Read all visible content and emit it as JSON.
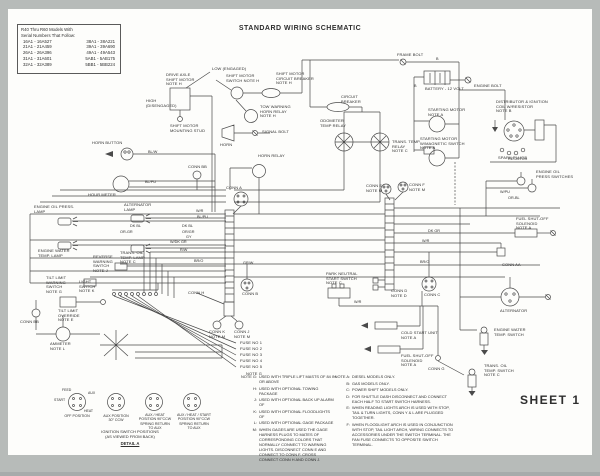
{
  "page": {
    "title": "STANDARD WIRING SCHEMATIC",
    "sheet_label": "SHEET 1"
  },
  "colors": {
    "ink": "#4a4a4a",
    "paper": "#fdfdfb",
    "frame_gray": "#b7bbb9"
  },
  "serial_box": {
    "heading1": "R40 Thru R60 Models With",
    "heading2": "Serial Numbers That Follow:",
    "rows": [
      [
        "16A1 - 16A527",
        "38A1 - 38A221"
      ],
      [
        "21A1 - 21A459",
        "39A1 - 39A690"
      ],
      [
        "26A1 - 26A396",
        "49A1 - 49A543"
      ],
      [
        "31A1 - 31A601",
        "5AB1 - 5AB175"
      ],
      [
        "32A1 - 32A389",
        "5BB1 - 5BB224"
      ]
    ]
  },
  "diagram": {
    "component_labels": [
      {
        "id": "low-engaged",
        "t": "LOW (ENGAGED)",
        "x": 212,
        "y": 67
      },
      {
        "id": "drive-axle-shift-motor",
        "t": "DRIVE AXLE\nSHIFT MOTOR\nNOTE H",
        "x": 166,
        "y": 73
      },
      {
        "id": "high-disengaged",
        "t": "HIGH\n(DISENGAGED)",
        "x": 146,
        "y": 99
      },
      {
        "id": "shift-motor-mounting-stud",
        "t": "SHIFT MOTOR\nMOUNTING STUD",
        "x": 170,
        "y": 124
      },
      {
        "id": "shift-motor-switch",
        "t": "SHIFT MOTOR\nSWITCH NOTE H",
        "x": 226,
        "y": 74
      },
      {
        "id": "shift-motor-circuit-breaker",
        "t": "SHIFT MOTOR\nCIRCUIT BREAKER\nNOTE H",
        "x": 276,
        "y": 72
      },
      {
        "id": "tow-warning-horn-relay",
        "t": "TOW WARNING\nHORN RELAY\nNOTE H",
        "x": 260,
        "y": 105
      },
      {
        "id": "horn",
        "t": "HORN",
        "x": 220,
        "y": 143
      },
      {
        "id": "signal-bolt",
        "t": "SIGNAL BOLT",
        "x": 262,
        "y": 130
      },
      {
        "id": "horn-relay",
        "t": "HORN RELAY",
        "x": 258,
        "y": 154
      },
      {
        "id": "frame-bolt",
        "t": "FRAME BOLT",
        "x": 397,
        "y": 53
      },
      {
        "id": "battery",
        "t": "BATTERY - 12 VOLT",
        "x": 425,
        "y": 87
      },
      {
        "id": "engine-bolt",
        "t": "ENGINE BOLT",
        "x": 474,
        "y": 84
      },
      {
        "id": "circuit-breaker",
        "t": "CIRCUIT\nBREAKER",
        "x": 341,
        "y": 95
      },
      {
        "id": "odometer-temp-relay",
        "t": "ODOMETER\nTEMP RELAY",
        "x": 320,
        "y": 119
      },
      {
        "id": "trans-temp-relay",
        "t": "TRANS. TEMP.\nRELAY\nNOTE C",
        "x": 392,
        "y": 140
      },
      {
        "id": "starting-motor",
        "t": "STARTING MOTOR\nNOTE A",
        "x": 428,
        "y": 108
      },
      {
        "id": "starting-motor-magnetic",
        "t": "STARTING MOTOR\nW/MAGNETIC SWITCH\nNOTE A",
        "x": 420,
        "y": 137
      },
      {
        "id": "distributor-ignition-coil",
        "t": "DISTRIBUTOR & IGNITION\nCOIL W/RESISTOR\nNOTE B",
        "x": 496,
        "y": 100
      },
      {
        "id": "spark-plugs",
        "t": "SPARK PLUGS",
        "x": 498,
        "y": 156
      },
      {
        "id": "engine-oil-press-switches",
        "t": "ENGINE OIL\nPRESS SWITCHES",
        "x": 536,
        "y": 170
      },
      {
        "id": "horn-button",
        "t": "HORN BUTTON",
        "x": 92,
        "y": 141
      },
      {
        "id": "hour-meter",
        "t": "HOUR METER",
        "x": 88,
        "y": 193
      },
      {
        "id": "engine-oil-press-lamp",
        "t": "ENGINE OIL PRESS.\nLAMP",
        "x": 34,
        "y": 205
      },
      {
        "id": "alternator-lamp",
        "t": "ALTERNATOR\nLAMP",
        "x": 124,
        "y": 203
      },
      {
        "id": "engine-water-temp-lamp",
        "t": "ENGINE WATER\nTEMP. LAMP",
        "x": 38,
        "y": 249
      },
      {
        "id": "trans-oil-temp-lamp",
        "t": "TRANS. OIL\nTEMP. LAMP\nNOTE C",
        "x": 120,
        "y": 251
      },
      {
        "id": "reverse-warning-switch",
        "t": "REVERSE\nWARNING\nSWITCH\nNOTE J",
        "x": 93,
        "y": 255
      },
      {
        "id": "tilt-limit-warning-switch",
        "t": "TILT LIMIT\nWARNING\nSWITCH\nNOTE G",
        "x": 46,
        "y": 276
      },
      {
        "id": "light-switch",
        "t": "LIGHT\nSWITCH\nNOTE K",
        "x": 79,
        "y": 280
      },
      {
        "id": "tilt-limit-override",
        "t": "TILT LIMIT\nOVERRIDE\nNOTE E",
        "x": 58,
        "y": 309
      },
      {
        "id": "conn-bb-left",
        "t": "CONN BB",
        "x": 20,
        "y": 320
      },
      {
        "id": "ammeter",
        "t": "AMMETER\nNOTE L",
        "x": 50,
        "y": 342
      },
      {
        "id": "conn-bb-mid",
        "t": "CONN BB",
        "x": 188,
        "y": 165
      },
      {
        "id": "conn-a",
        "t": "CONN A",
        "x": 226,
        "y": 186
      },
      {
        "id": "conn-e",
        "t": "CONN E\nNOTE M",
        "x": 366,
        "y": 184
      },
      {
        "id": "conn-f",
        "t": "CONN F\nNOTE M",
        "x": 409,
        "y": 183
      },
      {
        "id": "conn-h",
        "t": "CONN H",
        "x": 188,
        "y": 291
      },
      {
        "id": "conn-k",
        "t": "CONN K\nNOTE M",
        "x": 209,
        "y": 330
      },
      {
        "id": "conn-j",
        "t": "CONN J\nNOTE M",
        "x": 234,
        "y": 330
      },
      {
        "id": "conn-b",
        "t": "CONN B",
        "x": 242,
        "y": 292
      },
      {
        "id": "park-neutral-start-switch",
        "t": "PARK NEUTRAL\nSTART SWITCH\nNOTE C",
        "x": 326,
        "y": 272
      },
      {
        "id": "conn-d",
        "t": "CONN D\nNOTE D",
        "x": 391,
        "y": 289
      },
      {
        "id": "cold-start-unit",
        "t": "COLD START UNIT\nNOTE A",
        "x": 401,
        "y": 331
      },
      {
        "id": "fuel-shut-off-solenoid",
        "t": "FUEL SHUT-OFF\nSOLENOID\nNOTE A",
        "x": 401,
        "y": 354
      },
      {
        "id": "fuel-shut-off-solenoid-2",
        "t": "FUEL SHUT-OFF\nSOLENOID\nNOTE A",
        "x": 516,
        "y": 217
      },
      {
        "id": "conn-aa",
        "t": "CONN AA",
        "x": 502,
        "y": 263
      },
      {
        "id": "conn-c",
        "t": "CONN C",
        "x": 424,
        "y": 293
      },
      {
        "id": "alternator",
        "t": "ALTERNATOR",
        "x": 500,
        "y": 309
      },
      {
        "id": "engine-water-temp-switch",
        "t": "ENGINE WATER\nTEMP. SWITCH",
        "x": 494,
        "y": 328
      },
      {
        "id": "trans-oil-temp-switch",
        "t": "TRANS. OIL\nTEMP. SWITCH\nNOTE C",
        "x": 484,
        "y": 364
      },
      {
        "id": "conn-g",
        "t": "CONN G",
        "x": 428,
        "y": 367
      },
      {
        "id": "fuse-1",
        "t": "FUSE NO 1",
        "x": 240,
        "y": 341
      },
      {
        "id": "fuse-2",
        "t": "FUSE NO 2",
        "x": 240,
        "y": 347
      },
      {
        "id": "fuse-3",
        "t": "FUSE NO 3",
        "x": 240,
        "y": 353
      },
      {
        "id": "fuse-4",
        "t": "FUSE NO 4",
        "x": 240,
        "y": 359
      },
      {
        "id": "fuse-5",
        "t": "FUSE NO 5",
        "x": 240,
        "y": 365
      },
      {
        "id": "note-g-ref",
        "t": "NOTE G",
        "x": 246,
        "y": 372
      }
    ],
    "wire_labels": [
      {
        "t": "BL/W",
        "x": 148,
        "y": 150
      },
      {
        "t": "BL/PU",
        "x": 145,
        "y": 180
      },
      {
        "t": "W/R",
        "x": 196,
        "y": 209
      },
      {
        "t": "BL/PU",
        "x": 197,
        "y": 215
      },
      {
        "t": "DK BL",
        "x": 182,
        "y": 224
      },
      {
        "t": "OR/GR",
        "x": 182,
        "y": 230
      },
      {
        "t": "GY",
        "x": 186,
        "y": 235
      },
      {
        "t": "W/DK GR",
        "x": 170,
        "y": 240
      },
      {
        "t": "R/W",
        "x": 180,
        "y": 248
      },
      {
        "t": "BR/O",
        "x": 194,
        "y": 259
      },
      {
        "t": "GR/W",
        "x": 243,
        "y": 261
      },
      {
        "t": "DK BL",
        "x": 130,
        "y": 224
      },
      {
        "t": "OR-GR",
        "x": 120,
        "y": 230
      },
      {
        "t": "W/PU",
        "x": 500,
        "y": 190
      },
      {
        "t": "OR-BL",
        "x": 508,
        "y": 196
      },
      {
        "t": "RESISTOR",
        "x": 508,
        "y": 157
      },
      {
        "t": "DK GR",
        "x": 428,
        "y": 229
      },
      {
        "t": "W/R",
        "x": 422,
        "y": 239
      },
      {
        "t": "BR/O",
        "x": 420,
        "y": 260
      },
      {
        "t": "W/R",
        "x": 354,
        "y": 300
      },
      {
        "t": "B",
        "x": 436,
        "y": 57
      },
      {
        "t": "B",
        "x": 414,
        "y": 84
      }
    ]
  },
  "notes": {
    "left": [
      {
        "k": "NOTE G:",
        "t": "USED WITH TRIPLE LIFT MASTS OF 84 IN OR ABOVE"
      },
      {
        "k": "H:",
        "t": "USED WITH OPTIONAL TOWING PACKAGE"
      },
      {
        "k": "J:",
        "t": "USED WITH OPTIONAL BACK UP ALARM OF"
      },
      {
        "k": "K:",
        "t": "USED WITH OPTIONAL FLOODLIGHTS OF"
      },
      {
        "k": "L:",
        "t": "USED WITH OPTIONAL GAGE PACKAGE"
      },
      {
        "k": "M:",
        "t": "WHEN GAGES ARE USED THE GAGE HARNESS PLUGS TO MATES OF CORRESPONDING COLORS THAT NORMALLY CONNECT TO WARNING LIGHTS. DISCONNECT CONN E AND CONNECT TO CONN F. CROSS CONNECT CONN H AND CONN J."
      }
    ],
    "right": [
      {
        "k": "NOTE A:",
        "t": "DIESEL MODELS ONLY."
      },
      {
        "k": "B:",
        "t": "GAS MODELS ONLY."
      },
      {
        "k": "C:",
        "t": "POWER SHIFT MODELS ONLY."
      },
      {
        "k": "D:",
        "t": "FOR SHUTTLE DASH DISCONNECT AND CONNECT EACH HALF TO START SWITCH HARNESS."
      },
      {
        "k": "E:",
        "t": "WHEN READING LIGHTS ARCH IS USED WITH STOP, TAIL & TURN LIGHTS, CONN Y & L ARE PLUGGED TOGETHER."
      },
      {
        "k": "F:",
        "t": "WHEN FLOODLIGHT ARCH IS USED IN CONJUNCTION WITH STOP, TAIL LIGHT ARCH, WIRING CONNECTS TO ACCESSORIES UNDER THE SWITCH TERMINAL. THE FAN FUSE CONNECTS TO OPPOSITE SWITCH TERMINAL."
      }
    ]
  },
  "ignition_detail": {
    "dial_labels": [
      {
        "t": "FEED",
        "x": 62,
        "y": 388
      },
      {
        "t": "AUX",
        "x": 88,
        "y": 391
      },
      {
        "t": "START",
        "x": 54,
        "y": 398
      },
      {
        "t": "HEAT",
        "x": 84,
        "y": 409
      }
    ],
    "positions": [
      {
        "t": "OFF POSITION",
        "x": 77,
        "y": 414
      },
      {
        "t": "AUX POSITION\n30° CCW",
        "x": 116,
        "y": 414
      },
      {
        "t": "AUX / HEAT\nPOSITION 90°CCW\nSPRING RETURN\nTO AUX",
        "x": 155,
        "y": 413
      },
      {
        "t": "AUX / HEAT / START\nPOSITION 90°CCW\nSPRING RETURN\nTO AUX",
        "x": 194,
        "y": 413
      }
    ],
    "caption": "IGNITION SWITCH POSITIONS\n(AS VIEWED FROM BACK)",
    "detail_label": "DETAIL A"
  }
}
